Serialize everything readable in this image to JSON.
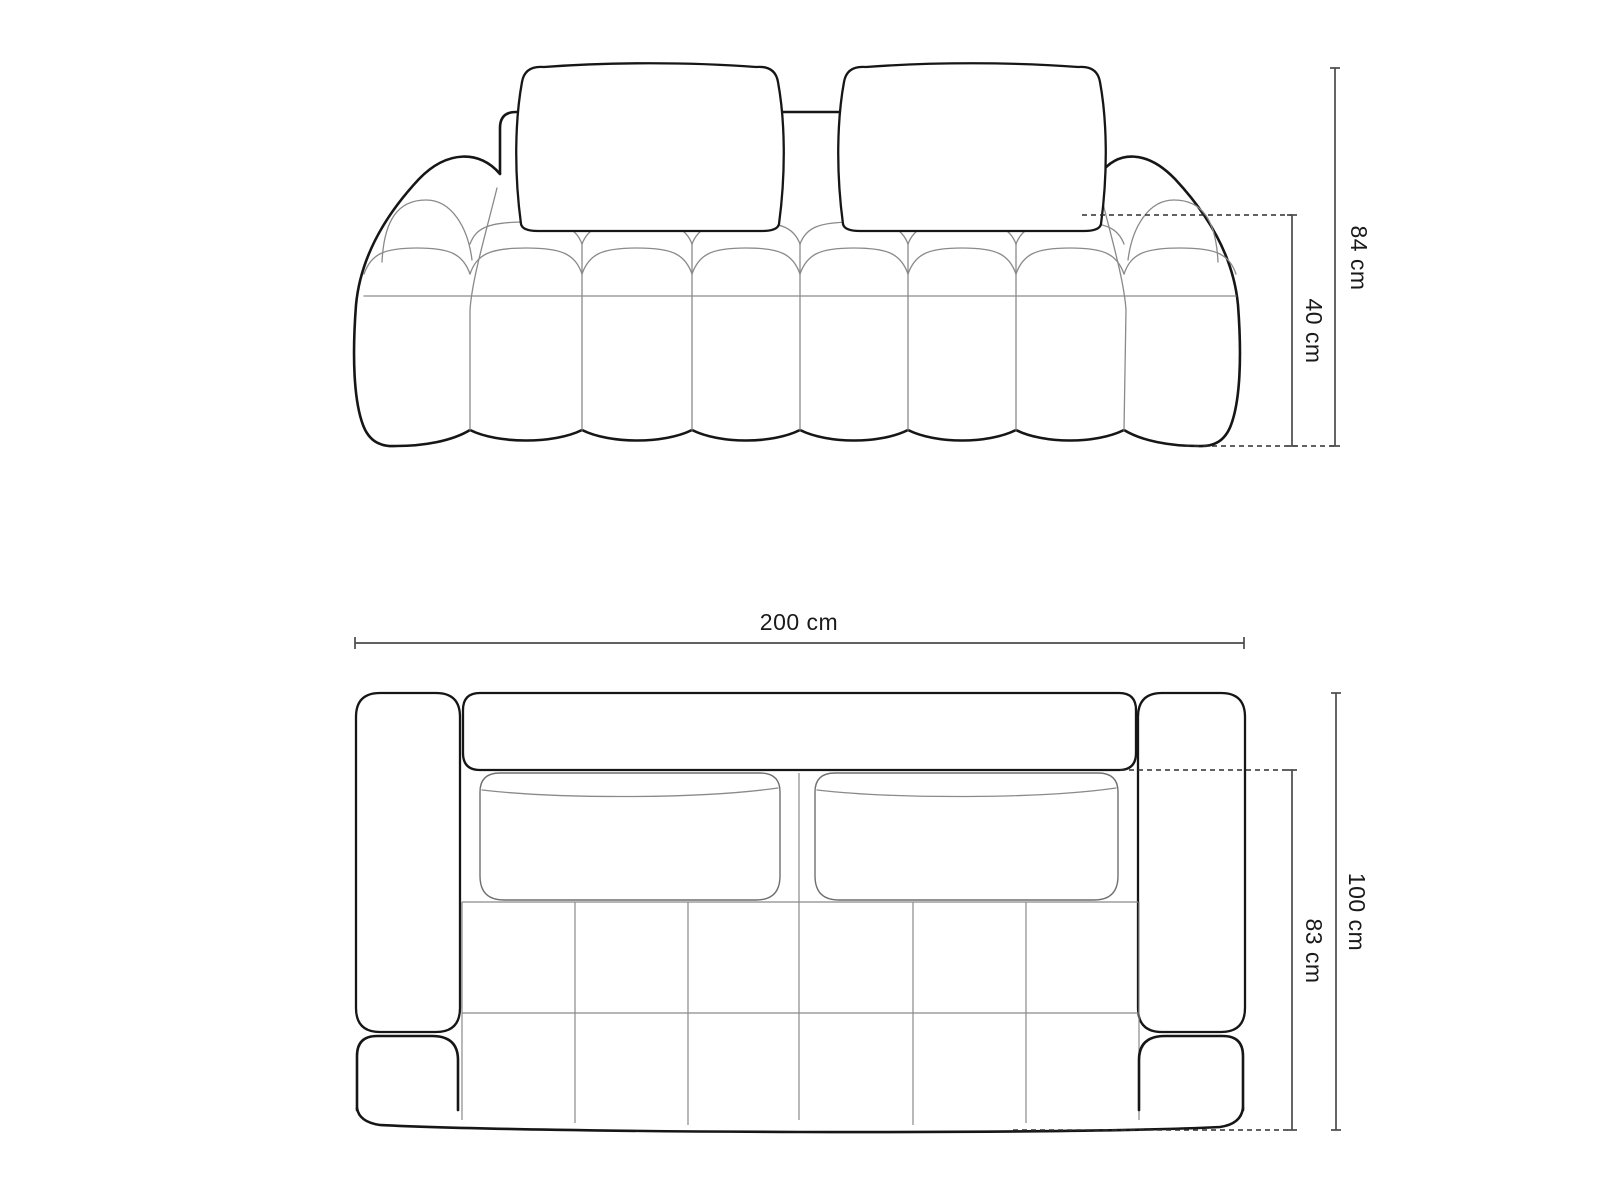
{
  "diagram": {
    "kind": "furniture dimension line drawing",
    "units": "cm"
  },
  "dimensions": {
    "front": {
      "total_height": {
        "label": "84 cm",
        "value": 84
      },
      "seat_height": {
        "label": "40 cm",
        "value": 40
      }
    },
    "top": {
      "width": {
        "label": "200 cm",
        "value": 200
      },
      "depth": {
        "label": "100 cm",
        "value": 100
      },
      "seat_depth": {
        "label": "83 cm",
        "value": 83
      }
    }
  },
  "colors": {
    "background": "#ffffff",
    "outline": "#161616",
    "seam_line": "#8a8a8a",
    "dimension_line": "#4a4a4a",
    "dashed_line": "#2f2f2f",
    "label_text": "#1a1a1a"
  }
}
